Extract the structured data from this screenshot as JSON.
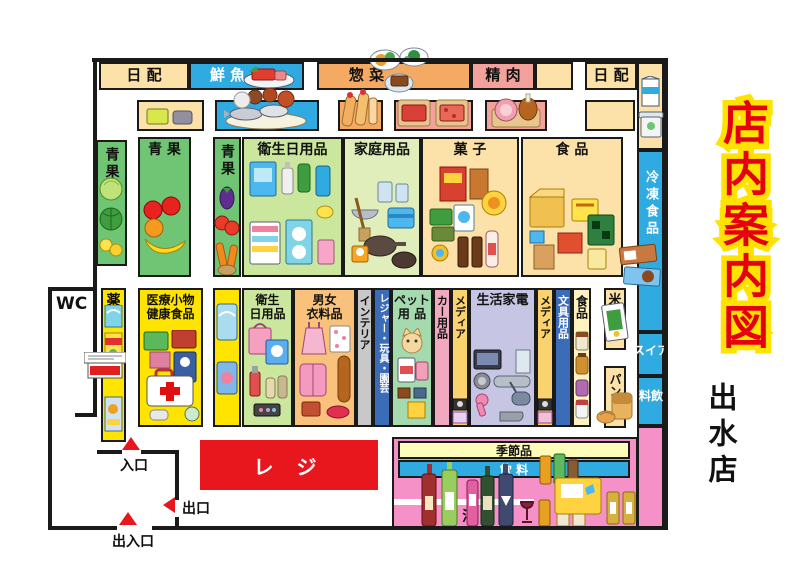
{
  "title": {
    "heading": "店内案内図",
    "store_name": "出水店"
  },
  "colors": {
    "title_red": "#e50011",
    "title_outline_yellow": "#ffe200",
    "register_red": "#e8161d",
    "fresh_blue": "#2fabe1",
    "daily_cream": "#fce1a8",
    "deli_orange": "#f5aa63",
    "meat_pink": "#f2a29b",
    "produce_green": "#6fc573",
    "drug_yellow": "#ffe400",
    "liquor_pink": "#f591c6",
    "media_gold": "#fbd36e",
    "appliance_lavender": "#c6c6e4",
    "stationery_blue": "#3a6cb8",
    "wall_black": "#1a1a1a"
  },
  "sections": {
    "top": {
      "nippai_left": "日 配",
      "sengyo": "鮮 魚",
      "souzai": "惣 菜",
      "seiniku": "精 肉",
      "nippai_right": "日 配"
    },
    "row1": {
      "seika_v1": "青果",
      "seika": "青 果",
      "seika_v2": "青果",
      "eisei": "衛生日用品",
      "katei": "家庭用品",
      "kashi": "菓 子",
      "shokuhin": "食 品"
    },
    "row2": {
      "kusuri": "薬",
      "iryo": "医療小物\n健康食品",
      "eisei": "衛生\n日用品",
      "danjo": "男女\n衣料品",
      "interior": "インテリア",
      "leisure": "レジャー・玩具・園芸",
      "pet": "ペット\n用 品",
      "car": "カー用品",
      "media1": "メディア",
      "kaden": "生活家電",
      "media2": "メディア",
      "bungu": "文具用品",
      "shokuhin": "食品",
      "kome": "米",
      "pan": "パン"
    },
    "right": {
      "reitou": "冷凍食品",
      "ice": "アイス",
      "inryo": "飲料"
    },
    "bottom": {
      "reji": "レ ジ",
      "kisetsu": "季節品",
      "inryo": "飲 料",
      "osake": "お 酒"
    }
  },
  "facilities": {
    "wc": "WC"
  },
  "markers": {
    "iriguchi": "入口",
    "deguchi": "出口",
    "deiriguchi": "出入口"
  }
}
